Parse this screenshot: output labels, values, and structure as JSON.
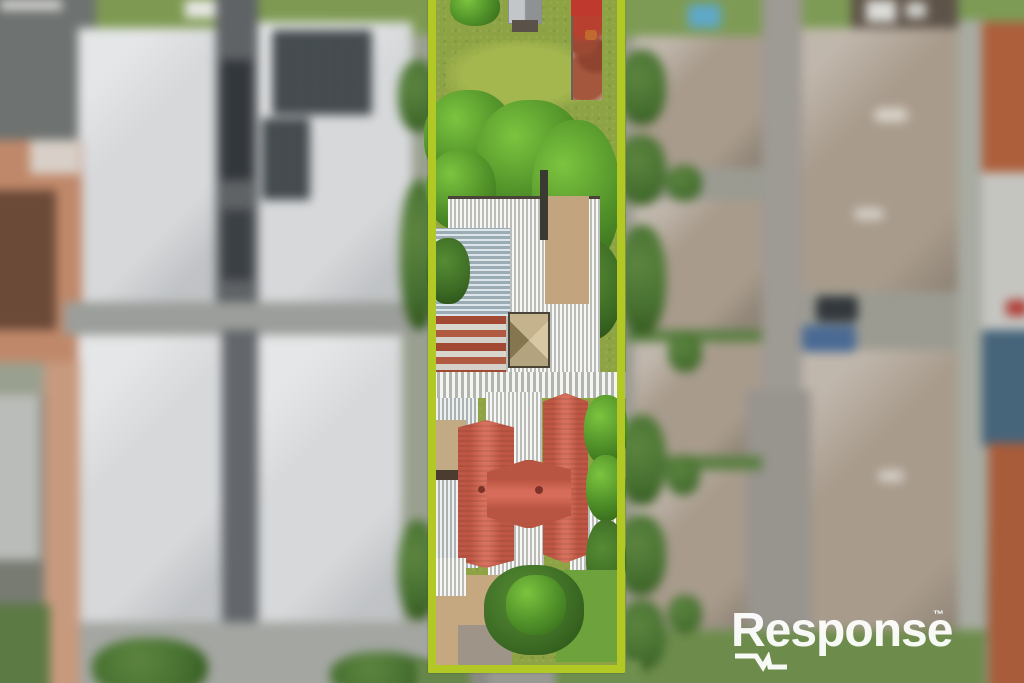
{
  "watermark": {
    "brand": "Response",
    "trademark": "™"
  },
  "scene": {
    "kind": "aerial-photograph",
    "regions": {
      "center": "highlighted-property-lot",
      "left": "blurred-neighbouring-townhouses",
      "right": "blurred-neighbouring-townhouses"
    }
  },
  "colors": {
    "boundary-green": "#b2c824",
    "house-roof-red": "#d2604b",
    "rust-roof-red": "#a24934",
    "corrugated-white": "#e9eae6",
    "corrugated-blue": "#b9ccd4",
    "neighbour-roof-grey": "#d6d8da",
    "neighbour-roof-taupe": "#a89b8c",
    "terracotta-roof": "#ad5f3c",
    "grass-green": "#8da344",
    "tree-green": "#4f8f28",
    "driveway-grey": "#5f6366",
    "watermark-white": "#ffffff"
  }
}
